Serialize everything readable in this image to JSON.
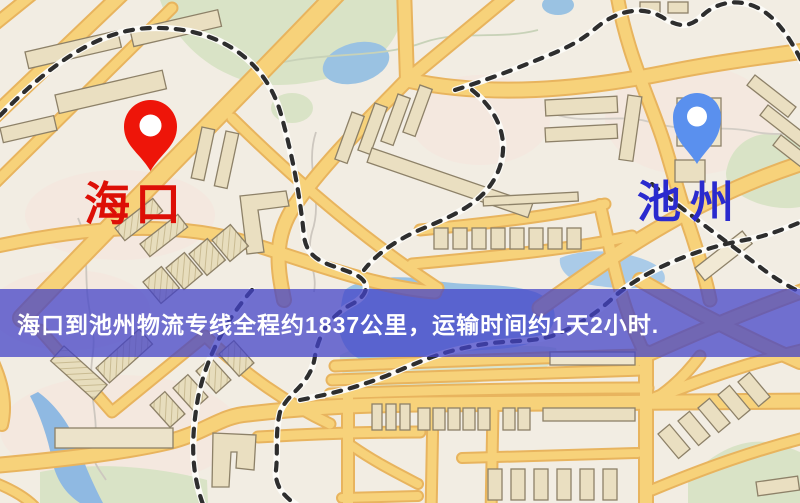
{
  "markers": {
    "origin": {
      "label": "海口",
      "pin_color": "#ee1509",
      "pin_hole_color": "#ffffff",
      "label_color": "#dd0f06",
      "pin_icon": "map-pin-icon"
    },
    "destination": {
      "label": "池州",
      "pin_color": "#5a90ee",
      "pin_hole_color": "#ffffff",
      "label_color": "#2a2ace",
      "pin_icon": "map-pin-icon"
    }
  },
  "banner": {
    "text": "海口到池州物流专线全程约1837公里，运输时间约1天2小时.",
    "distance_km": "1837",
    "duration": "1天2小时",
    "bg_color": "rgba(66,66,200,0.74)",
    "text_color": "#ffffff"
  },
  "map": {
    "style": "street-map",
    "background_color": "#f2ede3",
    "road_color": "#f7d27a",
    "road_casing_color": "#e8b45e",
    "water_color": "#9ac2e2",
    "park_color": "#d9e3c6",
    "building_color": "#eadfc1",
    "building_outline_color": "#8d8168",
    "railway_color": "#2e2e2e",
    "railway_base_color": "#fcfbf7"
  }
}
